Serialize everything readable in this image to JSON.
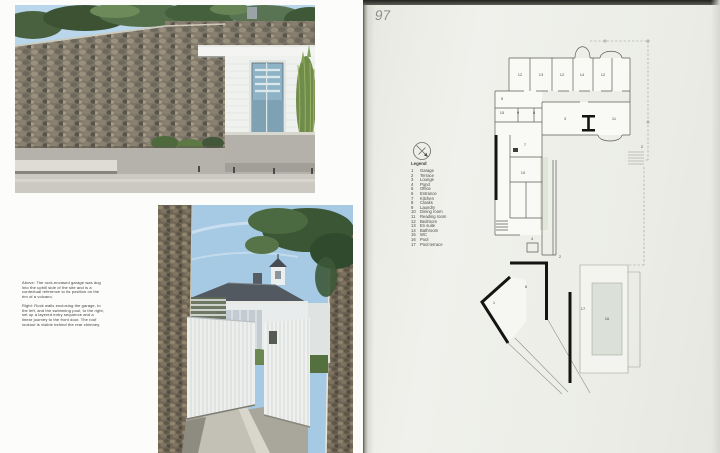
{
  "page": {
    "number": "97"
  },
  "captions": {
    "above": "Above: The rock-encased garage was dug into the uphill side of the site and is a contextual reference to its position on the rim of a volcano.",
    "right": "Right: Rock walls enclosing the garage, to the left, and the swimming pool, to the right, set up a layered entry sequence and a linear journey to the front door. The roof lookout is visible behind the rear chimney."
  },
  "legend": {
    "title": "Legend",
    "items": [
      {
        "num": "1",
        "label": "Garage"
      },
      {
        "num": "2",
        "label": "Terrace"
      },
      {
        "num": "3",
        "label": "Lounge"
      },
      {
        "num": "4",
        "label": "Pond"
      },
      {
        "num": "5",
        "label": "Office"
      },
      {
        "num": "6",
        "label": "Entrance"
      },
      {
        "num": "7",
        "label": "Kitchen"
      },
      {
        "num": "8",
        "label": "Cloaks"
      },
      {
        "num": "9",
        "label": "Laundry"
      },
      {
        "num": "10",
        "label": "Dining room"
      },
      {
        "num": "11",
        "label": "Reading room"
      },
      {
        "num": "12",
        "label": "Bedroom"
      },
      {
        "num": "13",
        "label": "En suite"
      },
      {
        "num": "14",
        "label": "Bathroom"
      },
      {
        "num": "15",
        "label": "WC"
      },
      {
        "num": "16",
        "label": "Pool"
      },
      {
        "num": "17",
        "label": "Pool terrace"
      }
    ]
  },
  "floor_plan": {
    "room_labels": [
      {
        "n": "12",
        "x": 90,
        "y": 54
      },
      {
        "n": "13",
        "x": 111,
        "y": 54
      },
      {
        "n": "12",
        "x": 132,
        "y": 54
      },
      {
        "n": "14",
        "x": 152,
        "y": 54
      },
      {
        "n": "12",
        "x": 173,
        "y": 54
      },
      {
        "n": "3",
        "x": 135,
        "y": 98
      },
      {
        "n": "11",
        "x": 184,
        "y": 98
      },
      {
        "n": "2",
        "x": 212,
        "y": 126
      },
      {
        "n": "5",
        "x": 72,
        "y": 78
      },
      {
        "n": "15",
        "x": 72,
        "y": 92
      },
      {
        "n": "9",
        "x": 88,
        "y": 92
      },
      {
        "n": "8",
        "x": 104,
        "y": 92
      },
      {
        "n": "7",
        "x": 95,
        "y": 124
      },
      {
        "n": "10",
        "x": 93,
        "y": 152
      },
      {
        "n": "4",
        "x": 102,
        "y": 218
      },
      {
        "n": "6",
        "x": 96,
        "y": 266
      },
      {
        "n": "1",
        "x": 64,
        "y": 282
      },
      {
        "n": "2",
        "x": 130,
        "y": 236
      },
      {
        "n": "17",
        "x": 153,
        "y": 288
      },
      {
        "n": "16",
        "x": 177,
        "y": 298
      }
    ]
  },
  "colors": {
    "pool_fill": "#dbe0d8",
    "plan_line": "#5c5c56",
    "plan_heavy": "#141412",
    "right_page_bg": "#edeee8",
    "caption_text": "#3c3c3a",
    "page_number": "#8e9090"
  }
}
